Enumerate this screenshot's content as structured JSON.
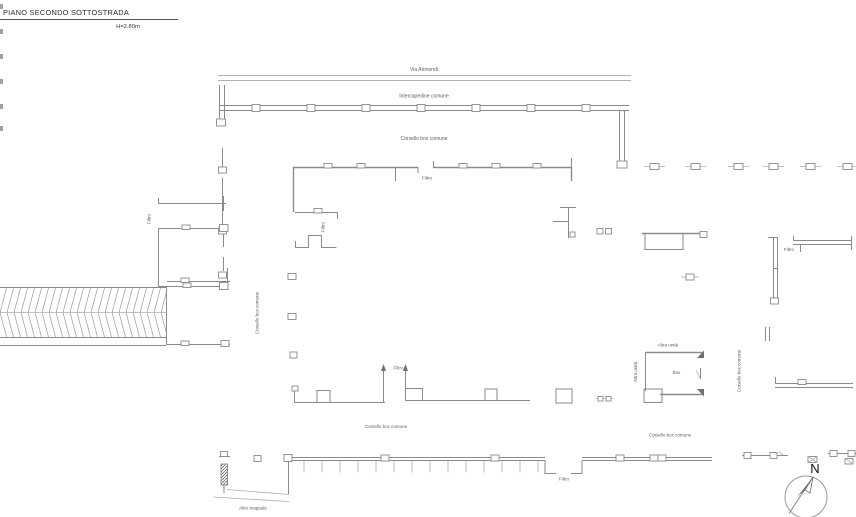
{
  "sheet": {
    "title": "PIANO SECONDO SOTTOSTRADA",
    "height_note": "H=2.80m"
  },
  "labels": {
    "street": "Via Arimondi",
    "intercapedine": "Intercapedine comune",
    "corsello": "Corsello box comune",
    "filtro": "Filtro",
    "altra_unita": "Altra unità",
    "box": "Box",
    "altro_mappale": "Altro mappale"
  },
  "compass": {
    "north": "N"
  },
  "colors": {
    "wall_line": "#8a8a8a",
    "label_text": "#5c5c5c",
    "title_text": "#2b2b2b"
  }
}
